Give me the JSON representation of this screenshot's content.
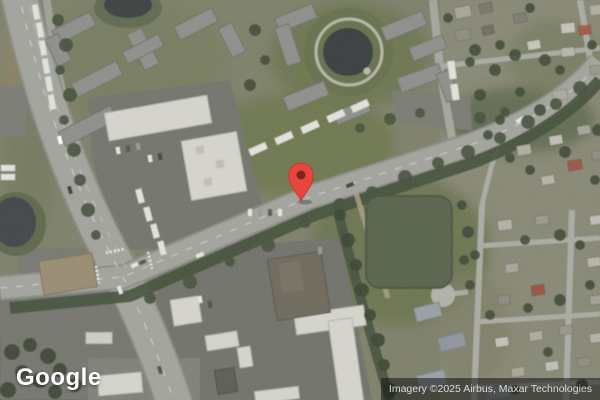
{
  "map": {
    "view_type": "satellite",
    "logo": "Google",
    "attribution": "Imagery ©2025 Airbus, Maxar Technologies",
    "marker": {
      "label": "location-pin",
      "x": 301,
      "y": 201,
      "color": "#E8453C",
      "inner_color": "#7E241B"
    },
    "colors": {
      "vegetation_base": "#7e8069",
      "grass": "#6d774e",
      "trees": "#3f4b37",
      "road": "#a3a49c",
      "residential_street": "#abaca4",
      "asphalt_lot": "#73746c",
      "roof_white": "#d8d8d0",
      "roof_gray": "#8e8f8a",
      "roof_brown": "#998d72",
      "pond_dark": "#3b4140",
      "pond_green": "#59634b",
      "attribution_bg": "rgba(20,20,20,0.55)",
      "attribution_text": "#dcdcdc"
    }
  }
}
